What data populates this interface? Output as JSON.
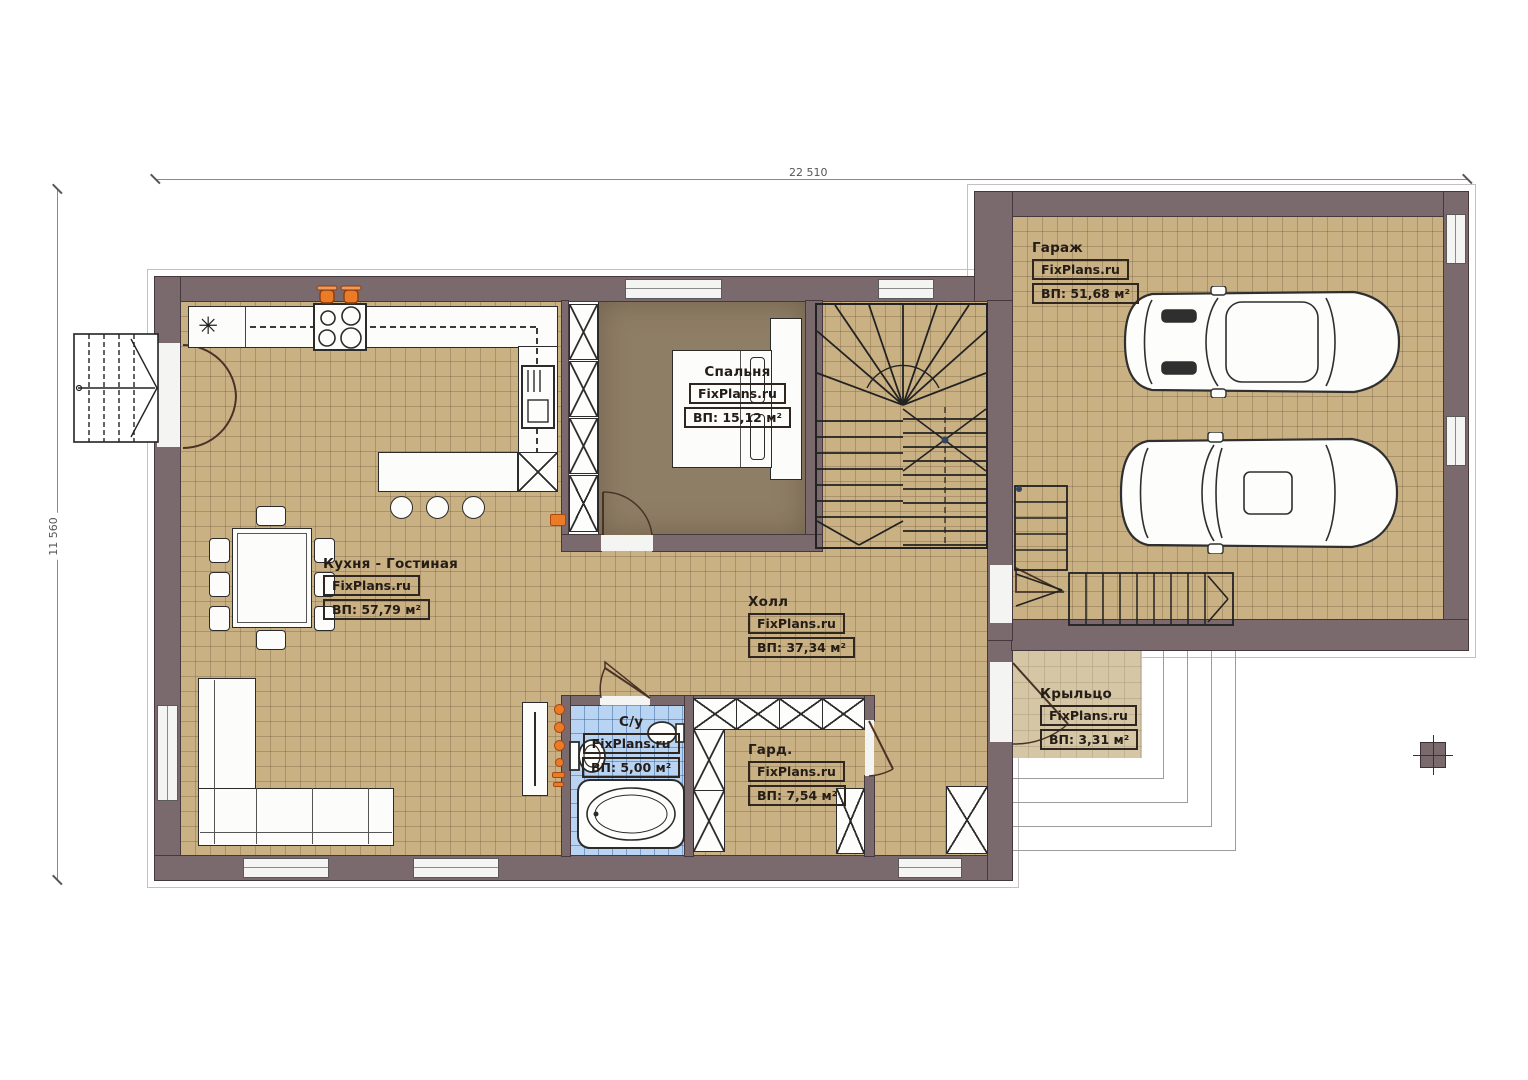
{
  "brand": "FixPlans.ru",
  "dimensions": {
    "top": "22 510",
    "left": "11 560"
  },
  "rooms": [
    {
      "id": "garage",
      "name": "Гараж",
      "brand": "FixPlans.ru",
      "area": "ВП: 51,68 м²"
    },
    {
      "id": "bedroom",
      "name": "Спальня",
      "brand": "FixPlans.ru",
      "area": "ВП: 15,12 м²"
    },
    {
      "id": "kitchen",
      "name": "Кухня - Гостиная",
      "brand": "FixPlans.ru",
      "area": "ВП: 57,79 м²"
    },
    {
      "id": "hall",
      "name": "Холл",
      "brand": "FixPlans.ru",
      "area": "ВП: 37,34 м²"
    },
    {
      "id": "bathroom",
      "name": "С/у",
      "brand": "FixPlans.ru",
      "area": "ВП: 5,00 м²"
    },
    {
      "id": "wardrobe",
      "name": "Гард.",
      "brand": "FixPlans.ru",
      "area": "ВП: 7,54 м²"
    },
    {
      "id": "porch",
      "name": "Крыльцо",
      "brand": "FixPlans.ru",
      "area": "ВП: 3,31 м²"
    }
  ],
  "symbols": {
    "sink_star": "✳"
  },
  "colors": {
    "wall": "#7b6a6d",
    "floor_tile": "#c9b184",
    "bedroom_carpet": "#8f7e66",
    "bathroom_tile": "#b9d3f2",
    "porch": "#d5c6a6",
    "accent_orange": "#ec7b28"
  }
}
